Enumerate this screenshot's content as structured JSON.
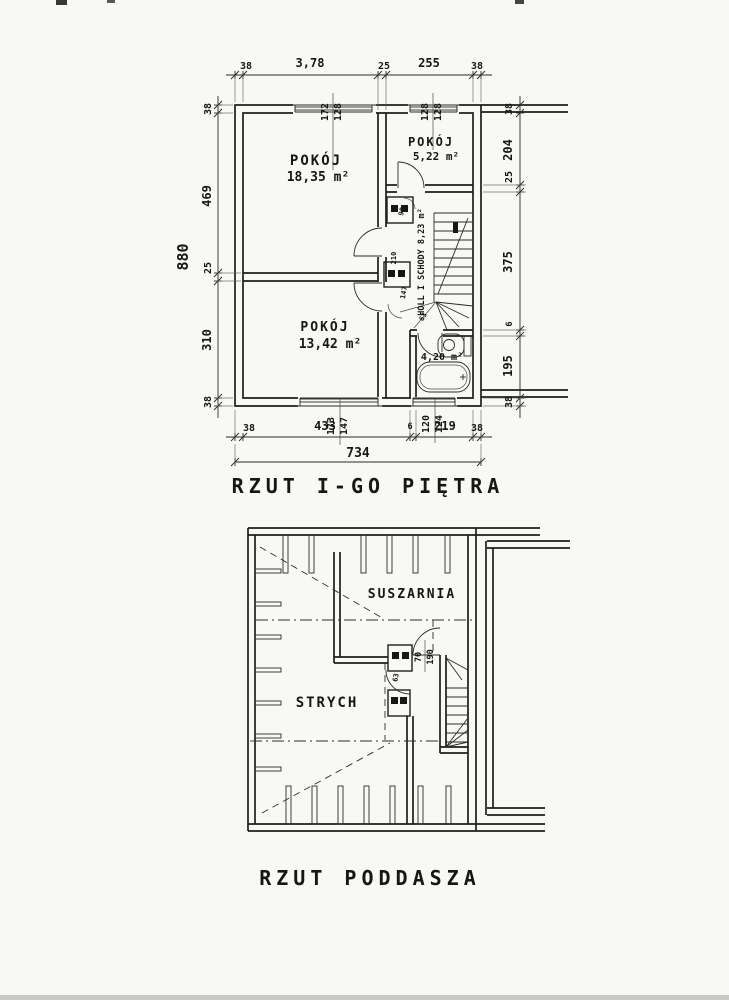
{
  "titles": {
    "floor1": "RZUT I-GO PIĘTRA",
    "attic": "RZUT PODDASZA"
  },
  "floor1": {
    "rooms": {
      "room1_name": "POKÓJ",
      "room1_area": "18,35 m²",
      "room2_name": "POKÓJ",
      "room2_area": "5,22 m²",
      "room3_name": "POKÓJ",
      "room3_area": "13,42 m²",
      "hall_label": "HOLL I SCHODY 8,23 m²",
      "bath_area": "4,20 m²"
    },
    "dims": {
      "top": [
        "38",
        "3,78",
        "25",
        "255",
        "38"
      ],
      "left": [
        "38",
        "469",
        "25",
        "310",
        "38"
      ],
      "left_total": "880",
      "right": [
        "38",
        "204",
        "25",
        "375",
        "6",
        "195",
        "38"
      ],
      "bottom": [
        "38",
        "433",
        "6",
        "219",
        "38"
      ],
      "bottom_total": "734"
    },
    "windows": {
      "top_left": {
        "w": "172",
        "h": "128"
      },
      "top_right": {
        "w": "128",
        "h": "128"
      },
      "bottom_left": {
        "w": "173",
        "h": "147"
      },
      "bottom_right": {
        "w": "120",
        "h": "124"
      }
    },
    "door_notes": [
      "90",
      "210",
      "147",
      "63"
    ]
  },
  "attic": {
    "rooms": {
      "drying": "SUSZARNIA",
      "storage": "STRYCH"
    },
    "door": {
      "w": "70",
      "h": "190"
    },
    "small_door_note": "63"
  }
}
